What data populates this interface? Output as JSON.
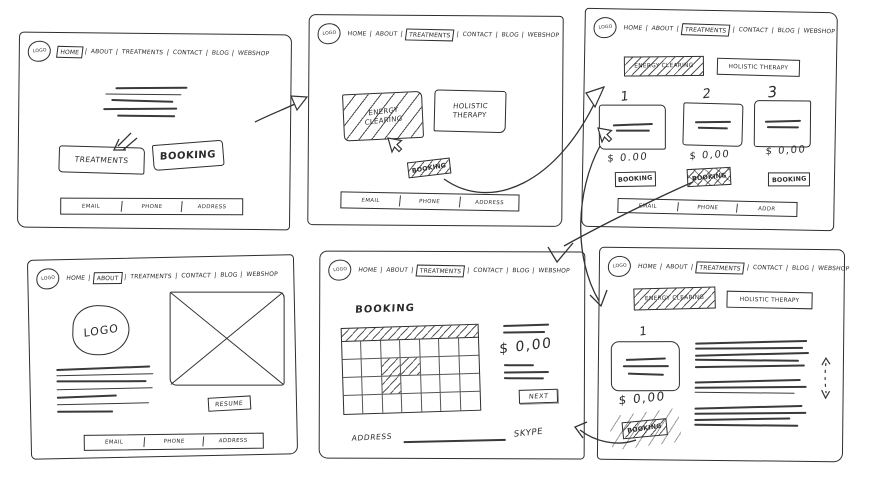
{
  "app": {
    "ink_color": "#2e2e2e",
    "paper_color": "#ffffff"
  },
  "nav": {
    "logo": "LOGO",
    "sep": "|",
    "items": [
      "HOME",
      "ABOUT",
      "TREATMENTS",
      "CONTACT",
      "BLOG",
      "WEBSHOP"
    ]
  },
  "footer": {
    "email": "EMAIL",
    "phone": "PHONE",
    "address": "ADDRESS",
    "address_short": "ADDR"
  },
  "home_page": {
    "treatments_button": "TREATMENTS",
    "booking_button": "BOOKING"
  },
  "treatments_page": {
    "energy_tab": "ENERGY CLEARING",
    "holistic_tab": "HOLISTIC THERAPY",
    "booking_button": "BOOKING"
  },
  "treatment_list_page": {
    "energy_tab": "ENERGY CLEARING",
    "holistic_tab": "HOLISTIC THERAPY",
    "items": [
      {
        "number": "1",
        "price": "$ 0.00",
        "booking_button": "BOOKING"
      },
      {
        "number": "2",
        "price": "$ 0,00",
        "booking_button": "BOOKING"
      },
      {
        "number": "3",
        "price": "$ 0,00",
        "booking_button": "BOOKING"
      }
    ]
  },
  "about_page": {
    "logo_text": "LOGO",
    "resume_button": "RESUME"
  },
  "booking_page": {
    "title": "BOOKING",
    "price": "$ 0,00",
    "next_button": "NEXT",
    "address_label": "ADDRESS",
    "skype_label": "SKYPE"
  },
  "detail_page": {
    "energy_tab": "ENERGY CLEARING",
    "holistic_tab": "HOLISTIC THERAPY",
    "number": "1",
    "price": "$ 0,00",
    "booking_button": "BOOKING"
  }
}
